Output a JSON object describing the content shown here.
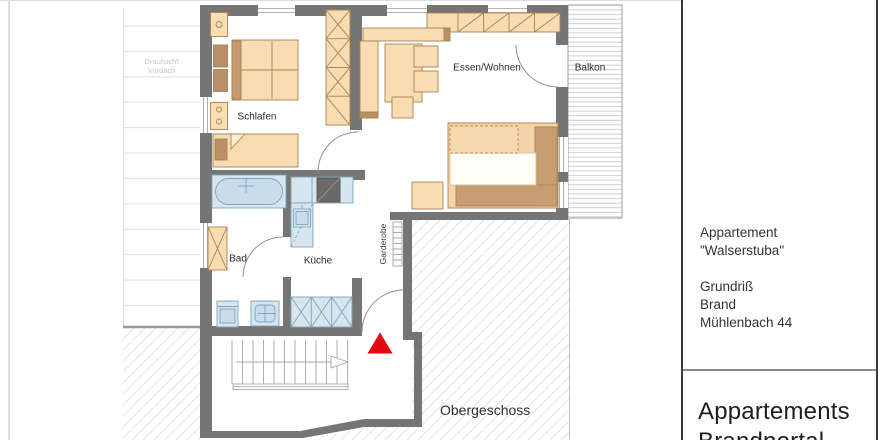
{
  "plan": {
    "room_labels": {
      "bedroom": "Schlafen",
      "living_dining": "Essen/Wohnen",
      "balcony": "Balkon",
      "bathroom": "Bad",
      "kitchen": "Küche",
      "wardrobe": "Garderobe"
    },
    "floor_label": "Obergeschoss",
    "canopy_label_line1": "Draufsicht",
    "canopy_label_line2": "Vordach"
  },
  "title_block": {
    "apartment_name_line1": "Appartement",
    "apartment_name_line2": "\"Walserstuba\"",
    "drawing_title": "Grundriß",
    "location": "Brand",
    "address": "Mühlenbach 44",
    "company_line1": "Appartements",
    "company_line2": "Brandnertal"
  },
  "colors": {
    "wall": "#757575",
    "furniture": "#f8dcb2",
    "furniture_accent": "#bb8f68",
    "fixture_blue": "#d6e5ee",
    "marker_red": "#e30613"
  }
}
